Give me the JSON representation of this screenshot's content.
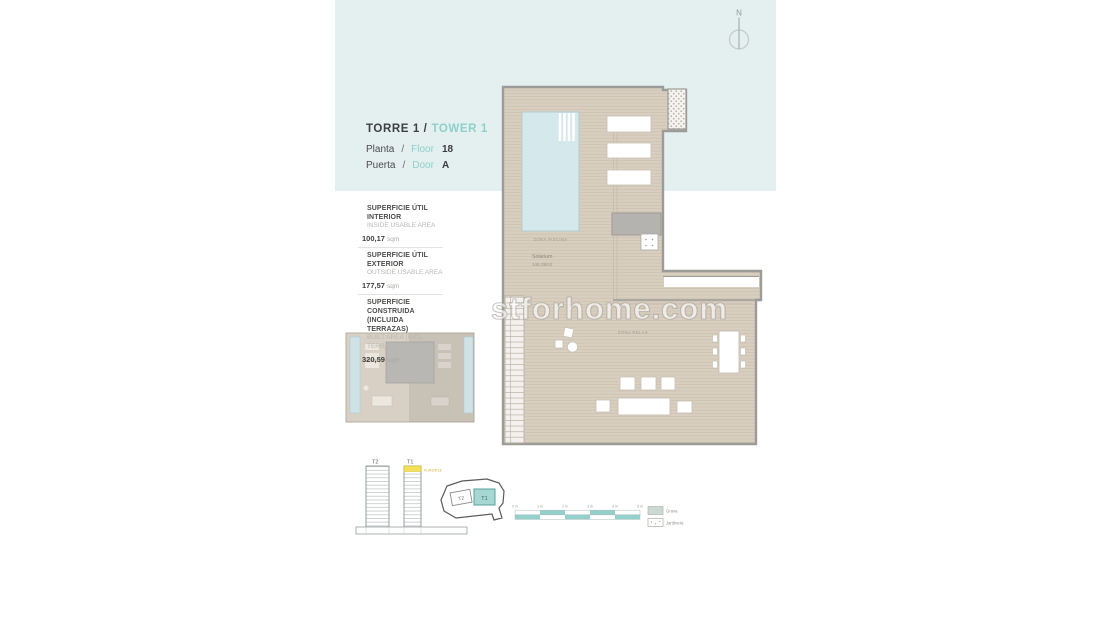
{
  "watermark": {
    "text": "stforhome.com"
  },
  "header": {
    "torre": "TORRE 1 /",
    "tower": "TOWER 1",
    "planta": "Planta",
    "slash": "/",
    "floor": "Floor",
    "floor_value": "18",
    "puerta": "Puerta",
    "door": "Door",
    "door_value": "A"
  },
  "areas": [
    {
      "title1": "SUPERFICIE ÚTIL INTERIOR",
      "title2": "",
      "subtitle": "INSIDE USABLE AREA",
      "value": "100,17",
      "unit": "sqm"
    },
    {
      "title1": "SUPERFICIE ÚTIL EXTERIOR",
      "title2": "",
      "subtitle": "OUTSIDE USABLE AREA",
      "value": "177,57",
      "unit": "sqm"
    },
    {
      "title1": "SUPERFICIE CONSTRUIDA",
      "title2": "(INCLUIDA TERRAZAS)",
      "subtitle": "BUILT AREA (INCL. TERRACE)",
      "value": "320,59",
      "unit": "sqm"
    }
  ],
  "plan": {
    "zona_piscina": "ZONA PISCINA",
    "solarium": "Solarium",
    "solarium_area": "146,28m2",
    "zona_relax": "ZONA RELAX"
  },
  "towers": {
    "t2": "T2",
    "t1": "T1",
    "floor_tag": "PLANTA 18"
  },
  "siteplan": {
    "t2": "T2",
    "t1": "T1"
  },
  "scalebar": {
    "labels": [
      "0 m",
      "1 m",
      "2 m",
      "3 m",
      "4 m",
      "5 m"
    ]
  },
  "legend": [
    {
      "label": "Grava"
    },
    {
      "label": "Jardinera"
    }
  ],
  "compass": {
    "label": "N"
  },
  "colors": {
    "accent_teal": "#8ecfcb",
    "background_blue": "#e4f0ef",
    "deck_tan": "#d9cfc1",
    "highlight_yellow": "#f2e056",
    "pool_blue": "#d5e8eb"
  }
}
